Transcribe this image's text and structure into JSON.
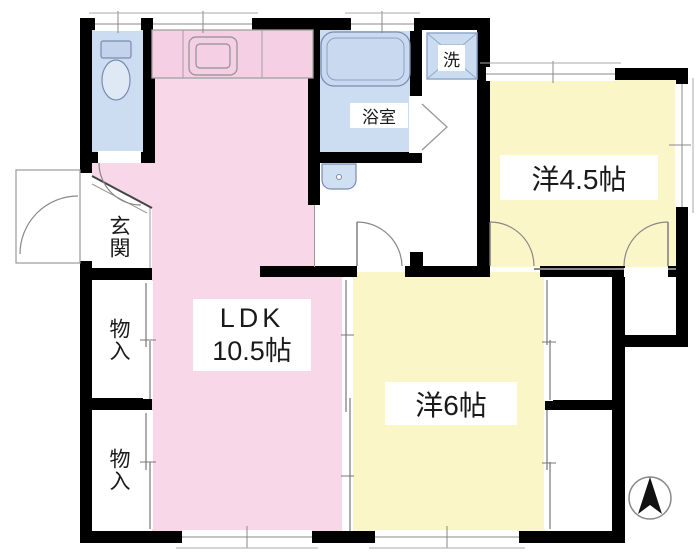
{
  "floorplan": {
    "type": "apartment-floor-plan",
    "labels": {
      "ldk_line1": "LDK",
      "ldk_line2": "10.5帖",
      "western_45": "洋4.5帖",
      "western_6": "洋6帖",
      "bathroom": "浴室",
      "washer": "洗",
      "entrance": "玄関",
      "storage_upper": "物入",
      "storage_lower": "物入"
    },
    "colors": {
      "ldk_pink": "#f8d7e8",
      "room_yellow": "#fbf6c8",
      "fixture_blue": "#cdddf1",
      "wall_black": "#000000",
      "line_gray": "#888888"
    },
    "compass": {
      "icon": "north-arrow"
    }
  }
}
